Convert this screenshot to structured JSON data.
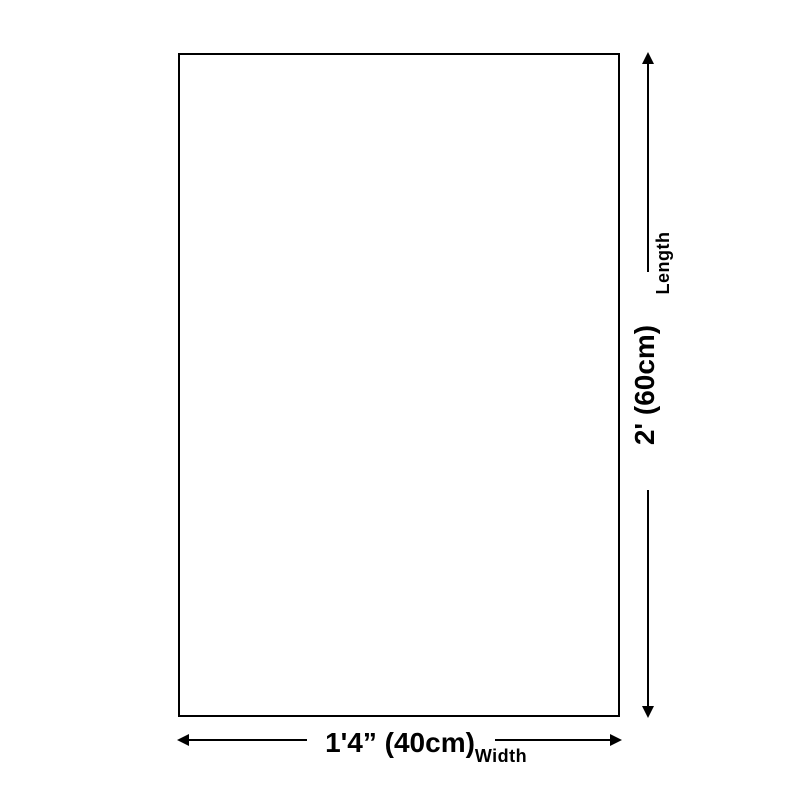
{
  "diagram": {
    "title": "product-size-diagram",
    "length": {
      "axis_label": "Length",
      "value": "2' (60cm)"
    },
    "width": {
      "axis_label": "Width",
      "value": "1'4” (40cm)"
    }
  },
  "colors": {
    "background": "#ffffff",
    "line": "#000000",
    "text": "#000000"
  }
}
